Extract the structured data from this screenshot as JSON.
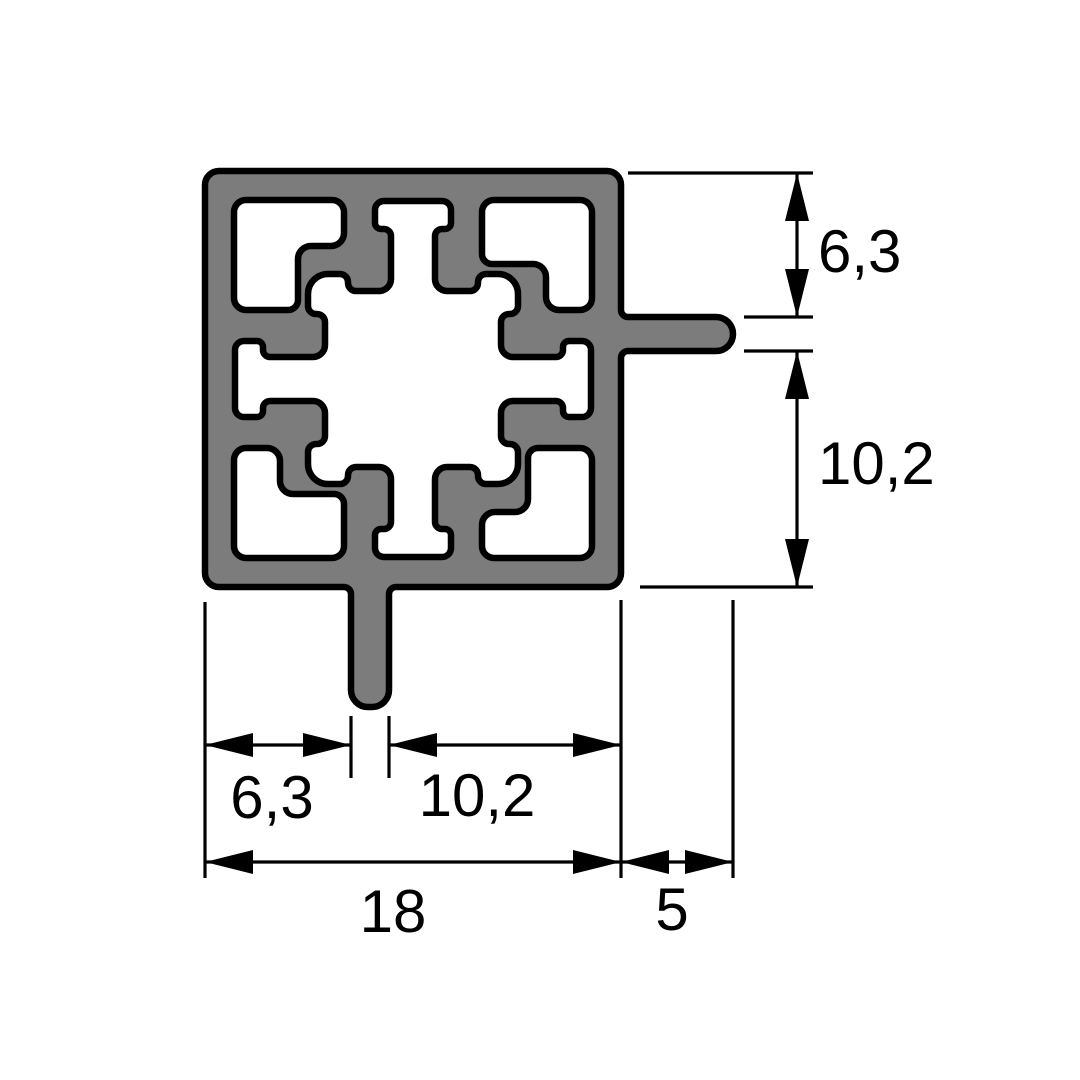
{
  "drawing": {
    "colors": {
      "profile_fill": "#7c7c7c",
      "profile_outline": "#000000",
      "dimension_color": "#000000",
      "background": "#ffffff"
    },
    "dimensions": {
      "right_vertical": [
        {
          "label": "6,3"
        },
        {
          "label": "10,2"
        }
      ],
      "bottom_horizontal": [
        {
          "label": "6,3"
        },
        {
          "label": "10,2"
        },
        {
          "label": "18"
        },
        {
          "label": "5"
        }
      ]
    }
  }
}
